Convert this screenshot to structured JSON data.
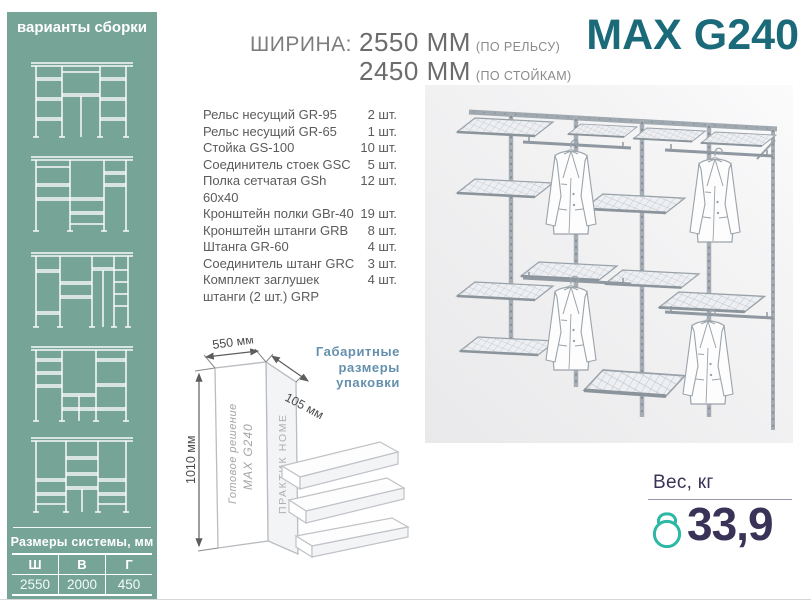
{
  "colors": {
    "sidebar_bg": "#76a497",
    "brand": "#1b6a79",
    "package_label": "#6490ad",
    "weight_text": "#3a3357",
    "kettlebell": "#2cb8a4",
    "spec_text": "#7d7d7d"
  },
  "sidebar": {
    "title": "варианты сборки",
    "variants": [
      {
        "name": "assembly-variant-1"
      },
      {
        "name": "assembly-variant-2"
      },
      {
        "name": "assembly-variant-3"
      },
      {
        "name": "assembly-variant-4"
      },
      {
        "name": "assembly-variant-5"
      }
    ],
    "system_dimensions": {
      "title": "Размеры системы, мм",
      "headers": [
        "Ш",
        "В",
        "Г"
      ],
      "values": [
        "2550",
        "2000",
        "450"
      ]
    }
  },
  "header": {
    "width_label": "ШИРИНА:",
    "lines": [
      {
        "value": "2550 ММ",
        "note": "(ПО РЕЛЬСУ)"
      },
      {
        "value": "2450 ММ",
        "note": "(ПО СТОЙКАМ)"
      }
    ],
    "product_name": "MAX G240"
  },
  "parts": {
    "items": [
      {
        "name": "Рельс несущий GR-95",
        "qty": "2 шт."
      },
      {
        "name": "Рельс несущий GR-65",
        "qty": "1 шт."
      },
      {
        "name": "Стойка GS-100",
        "qty": "10 шт."
      },
      {
        "name": "Соединитель стоек GSC",
        "qty": "5 шт."
      },
      {
        "name": "Полка сетчатая GSh 60x40",
        "qty": "12 шт."
      },
      {
        "name": "Кронштейн полки GBr-40",
        "qty": "19 шт."
      },
      {
        "name": "Кронштейн штанги GRB",
        "qty": "8 шт."
      },
      {
        "name": "Штанга GR-60",
        "qty": "4 шт."
      },
      {
        "name": "Соединитель штанг GRC",
        "qty": "3 шт."
      },
      {
        "name": "Комплект заглушек штанги (2 шт.) GRP",
        "qty": "4 шт."
      }
    ]
  },
  "package": {
    "label": "Габаритные размеры упаковки",
    "dim_width": "550 мм",
    "dim_depth": "105 мм",
    "dim_height": "1010 мм",
    "box_text_line1": "Готовое решение",
    "box_text_line2": "MAX G240",
    "box_side_text": "ПРАКТИК HOME"
  },
  "weight": {
    "label": "Вес, кг",
    "value": "33,9"
  }
}
